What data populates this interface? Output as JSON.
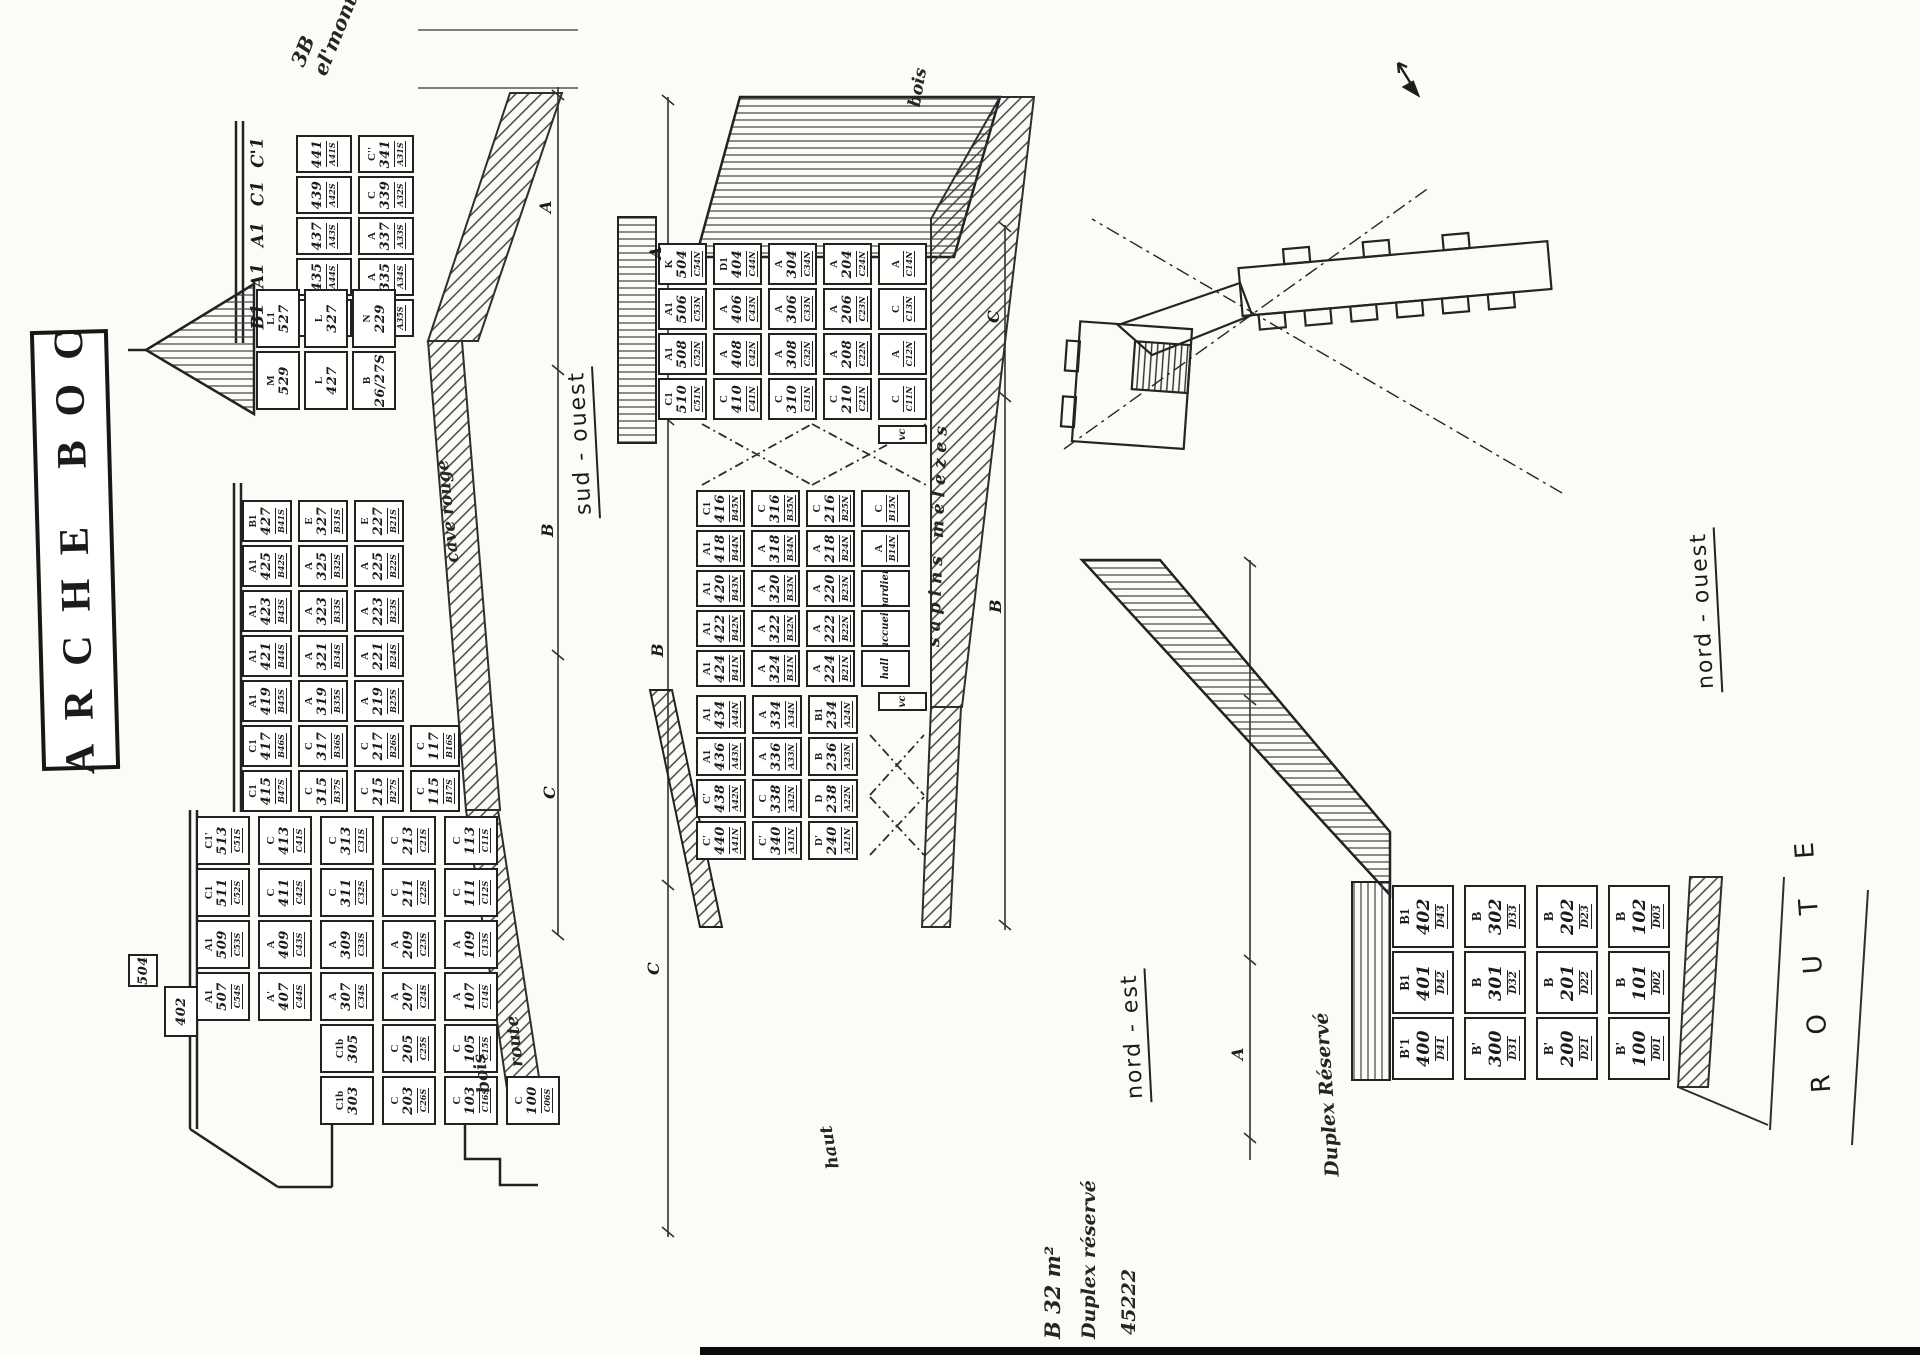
{
  "title": {
    "text": "ARCHE BOC"
  },
  "facades": {
    "sud_ouest": {
      "label": "sud - ouest"
    },
    "nord_est": {
      "label": "nord - est"
    },
    "nord_ouest": {
      "label": "nord - ouest"
    }
  },
  "route_label": "R O U T E",
  "dims": {
    "sud": [
      "A",
      "B",
      "C"
    ],
    "nord_top": [
      "A",
      "B",
      "C"
    ],
    "nord_bottom": [
      "C",
      "B"
    ],
    "ouest": [
      "A"
    ]
  },
  "annotations": {
    "corner_note": "3B  el'mont",
    "bois_top": "bois",
    "cave_note": "cave rouge",
    "sapin_note": "sapins  mélèzes",
    "haut_note": "haut",
    "bois_note": "bois",
    "route_note": "route",
    "duplex_note": "Duplex Réservé",
    "b32_1": "B 32 m²",
    "b32_2": "Duplex réservé",
    "b32_3": "45222"
  },
  "grids": {
    "so_upper": {
      "header": [
        "B1",
        "A1",
        "A1",
        "C1",
        "C'1"
      ],
      "cols": [
        {
          "cells": [
            {
              "n": "433",
              "c": "A45S"
            },
            {
              "t": "B",
              "n": "333",
              "c": "A35S"
            }
          ]
        },
        {
          "cells": [
            {
              "n": "435",
              "c": "A44S"
            },
            {
              "t": "A",
              "n": "335",
              "c": "A34S"
            }
          ]
        },
        {
          "cells": [
            {
              "n": "437",
              "c": "A43S"
            },
            {
              "t": "A",
              "n": "337",
              "c": "A33S"
            }
          ]
        },
        {
          "cells": [
            {
              "n": "439",
              "c": "A42S"
            },
            {
              "t": "C",
              "n": "339",
              "c": "A32S"
            }
          ]
        },
        {
          "cells": [
            {
              "n": "441",
              "c": "A41S"
            },
            {
              "t": "C''",
              "n": "341",
              "c": "A31S"
            }
          ]
        }
      ]
    },
    "so_chalet": {
      "cols": [
        {
          "cells": [
            {
              "t": "M",
              "n": "529"
            },
            {
              "t": "L",
              "n": "427"
            },
            {
              "t": "B",
              "n": "26/27S"
            }
          ]
        },
        {
          "cells": [
            {
              "t": "L1",
              "n": "527"
            },
            {
              "t": "L",
              "n": "327"
            },
            {
              "t": "N",
              "n": "229"
            }
          ]
        }
      ]
    },
    "so_mid": {
      "cols": [
        {
          "cells": [
            {
              "t": "C1",
              "n": "415",
              "c": "B47S"
            },
            {
              "t": "C",
              "n": "315",
              "c": "B37S"
            },
            {
              "t": "C",
              "n": "215",
              "c": "B27S"
            },
            {
              "t": "C",
              "n": "115",
              "c": "B17S"
            }
          ]
        },
        {
          "cells": [
            {
              "t": "C1",
              "n": "417",
              "c": "B46S"
            },
            {
              "t": "C",
              "n": "317",
              "c": "B36S"
            },
            {
              "t": "C",
              "n": "217",
              "c": "B26S"
            },
            {
              "t": "C",
              "n": "117",
              "c": "B16S"
            }
          ]
        },
        {
          "cells": [
            {
              "t": "A1",
              "n": "419",
              "c": "B45S"
            },
            {
              "t": "A",
              "n": "319",
              "c": "B35S"
            },
            {
              "t": "A",
              "n": "219",
              "c": "B25S"
            }
          ]
        },
        {
          "cells": [
            {
              "t": "A1",
              "n": "421",
              "c": "B44S"
            },
            {
              "t": "A",
              "n": "321",
              "c": "B34S"
            },
            {
              "t": "A",
              "n": "221",
              "c": "B24S"
            }
          ]
        },
        {
          "cells": [
            {
              "t": "A1",
              "n": "423",
              "c": "B43S"
            },
            {
              "t": "A",
              "n": "323",
              "c": "B33S"
            },
            {
              "t": "A",
              "n": "223",
              "c": "B23S"
            }
          ]
        },
        {
          "cells": [
            {
              "t": "A1",
              "n": "425",
              "c": "B42S"
            },
            {
              "t": "A",
              "n": "325",
              "c": "B32S"
            },
            {
              "t": "A",
              "n": "225",
              "c": "B22S"
            }
          ]
        },
        {
          "cells": [
            {
              "t": "B1",
              "n": "427",
              "c": "B41S"
            },
            {
              "t": "E",
              "n": "327",
              "c": "B31S"
            },
            {
              "t": "E",
              "n": "227",
              "c": "B21S"
            }
          ]
        }
      ]
    },
    "so_lower": {
      "cols": [
        {
          "cells": [
            {
              "t": "C1b",
              "n": "303"
            },
            {
              "t": "C",
              "n": "203",
              "c": "C26S"
            },
            {
              "t": "C",
              "n": "103",
              "c": "C16S"
            },
            {
              "t": "C",
              "n": "100",
              "c": "C06S"
            }
          ]
        },
        {
          "cells": [
            {
              "t": "C1b",
              "n": "305"
            },
            {
              "t": "C",
              "n": "205",
              "c": "C25S"
            },
            {
              "t": "C",
              "n": "105",
              "c": "C15S"
            }
          ]
        },
        {
          "cells": [
            {
              "t": "A1",
              "n": "507",
              "c": "C54S"
            },
            {
              "t": "A'",
              "n": "407",
              "c": "C44S"
            },
            {
              "t": "A",
              "n": "307",
              "c": "C34S"
            },
            {
              "t": "A",
              "n": "207",
              "c": "C24S"
            },
            {
              "t": "A",
              "n": "107",
              "c": "C14S"
            }
          ]
        },
        {
          "cells": [
            {
              "t": "A1",
              "n": "509",
              "c": "C53S"
            },
            {
              "t": "A",
              "n": "409",
              "c": "C43S"
            },
            {
              "t": "A",
              "n": "309",
              "c": "C33S"
            },
            {
              "t": "A",
              "n": "209",
              "c": "C23S"
            },
            {
              "t": "A",
              "n": "109",
              "c": "C13S"
            }
          ]
        },
        {
          "cells": [
            {
              "t": "C1",
              "n": "511",
              "c": "C52S"
            },
            {
              "t": "C",
              "n": "411",
              "c": "C42S"
            },
            {
              "t": "C",
              "n": "311",
              "c": "C32S"
            },
            {
              "t": "C",
              "n": "211",
              "c": "C22S"
            },
            {
              "t": "C",
              "n": "111",
              "c": "C12S"
            }
          ]
        },
        {
          "cells": [
            {
              "t": "C1'",
              "n": "513",
              "c": "C51S"
            },
            {
              "t": "C",
              "n": "413",
              "c": "C41S"
            },
            {
              "t": "C",
              "n": "313",
              "c": "C31S"
            },
            {
              "t": "C",
              "n": "213",
              "c": "C21S"
            },
            {
              "t": "C",
              "n": "113",
              "c": "C11S"
            }
          ]
        }
      ]
    },
    "so_504": {
      "cols": [
        {
          "cells": [
            {
              "n": "504"
            }
          ]
        }
      ]
    },
    "so_402": {
      "cols": [
        {
          "cells": [
            {
              "n": "402"
            }
          ]
        }
      ]
    },
    "ne_upper": {
      "cols": [
        {
          "cells": [
            {
              "t": "C1",
              "n": "510",
              "c": "C51N"
            },
            {
              "t": "C",
              "n": "410",
              "c": "C41N"
            },
            {
              "t": "C",
              "n": "310",
              "c": "C31N"
            },
            {
              "t": "C",
              "n": "210",
              "c": "C21N"
            },
            {
              "t": "C",
              "c": "C11N"
            }
          ]
        },
        {
          "cells": [
            {
              "t": "A1",
              "n": "508",
              "c": "C52N"
            },
            {
              "t": "A",
              "n": "408",
              "c": "C42N"
            },
            {
              "t": "A",
              "n": "308",
              "c": "C32N"
            },
            {
              "t": "A",
              "n": "208",
              "c": "C22N"
            },
            {
              "t": "A",
              "c": "C12N"
            }
          ]
        },
        {
          "cells": [
            {
              "t": "A1",
              "n": "506",
              "c": "C53N"
            },
            {
              "t": "A",
              "n": "406",
              "c": "C43N"
            },
            {
              "t": "A",
              "n": "306",
              "c": "C33N"
            },
            {
              "t": "A",
              "n": "206",
              "c": "C23N"
            },
            {
              "t": "C",
              "c": "C13N"
            }
          ]
        },
        {
          "cells": [
            {
              "t": "K",
              "n": "504",
              "c": "C54N"
            },
            {
              "t": "D1",
              "n": "404",
              "c": "C44N"
            },
            {
              "t": "A",
              "n": "304",
              "c": "C34N"
            },
            {
              "t": "A",
              "n": "204",
              "c": "C24N"
            },
            {
              "t": "A",
              "c": "C14N"
            }
          ]
        }
      ]
    },
    "ne_mid": {
      "cols": [
        {
          "cells": [
            {
              "t": "A1",
              "n": "424",
              "c": "B41N"
            },
            {
              "t": "A",
              "n": "324",
              "c": "B31N"
            },
            {
              "t": "A",
              "n": "224",
              "c": "B21N"
            },
            {
              "w": "hall"
            }
          ]
        },
        {
          "cells": [
            {
              "t": "A1",
              "n": "422",
              "c": "B42N"
            },
            {
              "t": "A",
              "n": "322",
              "c": "B32N"
            },
            {
              "t": "A",
              "n": "222",
              "c": "B22N"
            },
            {
              "w": "accueil"
            }
          ]
        },
        {
          "cells": [
            {
              "t": "A1",
              "n": "420",
              "c": "B43N"
            },
            {
              "t": "A",
              "n": "320",
              "c": "B33N"
            },
            {
              "t": "A",
              "n": "220",
              "c": "B23N"
            },
            {
              "w": "gardien"
            }
          ]
        },
        {
          "cells": [
            {
              "t": "A1",
              "n": "418",
              "c": "B44N"
            },
            {
              "t": "A",
              "n": "318",
              "c": "B34N"
            },
            {
              "t": "A",
              "n": "218",
              "c": "B24N"
            },
            {
              "t": "A",
              "c": "B14N"
            }
          ]
        },
        {
          "cells": [
            {
              "t": "C1",
              "n": "416",
              "c": "B45N"
            },
            {
              "t": "C",
              "n": "316",
              "c": "B35N"
            },
            {
              "t": "C",
              "n": "216",
              "c": "B25N"
            },
            {
              "t": "C",
              "c": "B15N"
            }
          ]
        }
      ]
    },
    "ne_lower": {
      "cols": [
        {
          "cells": [
            {
              "t": "C'",
              "n": "440",
              "c": "A41N"
            },
            {
              "t": "C'",
              "n": "340",
              "c": "A31N"
            },
            {
              "t": "D'",
              "n": "240",
              "c": "A21N"
            }
          ]
        },
        {
          "cells": [
            {
              "t": "C'",
              "n": "438",
              "c": "A42N"
            },
            {
              "t": "C",
              "n": "338",
              "c": "A32N"
            },
            {
              "t": "D",
              "n": "238",
              "c": "A22N"
            }
          ]
        },
        {
          "cells": [
            {
              "t": "A1",
              "n": "436",
              "c": "A43N"
            },
            {
              "t": "A",
              "n": "336",
              "c": "A33N"
            },
            {
              "t": "B",
              "n": "236",
              "c": "A23N"
            }
          ]
        },
        {
          "cells": [
            {
              "t": "A1",
              "n": "434",
              "c": "A44N"
            },
            {
              "t": "A",
              "n": "334",
              "c": "A34N"
            },
            {
              "t": "B1",
              "n": "234",
              "c": "A24N"
            }
          ]
        }
      ]
    },
    "nw_main": {
      "cols": [
        {
          "cells": [
            {
              "t": "B'1",
              "n": "400",
              "c": "D41"
            },
            {
              "t": "B'",
              "n": "300",
              "c": "D31"
            },
            {
              "t": "B'",
              "n": "200",
              "c": "D21"
            },
            {
              "t": "B'",
              "n": "100",
              "c": "D01"
            }
          ]
        },
        {
          "cells": [
            {
              "t": "B1",
              "n": "401",
              "c": "D42"
            },
            {
              "t": "B",
              "n": "301",
              "c": "D32"
            },
            {
              "t": "B",
              "n": "201",
              "c": "D22"
            },
            {
              "t": "B",
              "n": "101",
              "c": "D02"
            }
          ]
        },
        {
          "cells": [
            {
              "t": "B1",
              "n": "402",
              "c": "D43"
            },
            {
              "t": "B",
              "n": "302",
              "c": "D33"
            },
            {
              "t": "B",
              "n": "202",
              "c": "D23"
            },
            {
              "t": "B",
              "n": "102",
              "c": "D03"
            }
          ]
        }
      ]
    },
    "vc_a": {
      "cols": [
        {
          "cells": [
            {
              "w": "vc"
            }
          ]
        }
      ]
    },
    "vc_b": {
      "cols": [
        {
          "cells": [
            {
              "w": "vc"
            }
          ]
        }
      ]
    }
  }
}
